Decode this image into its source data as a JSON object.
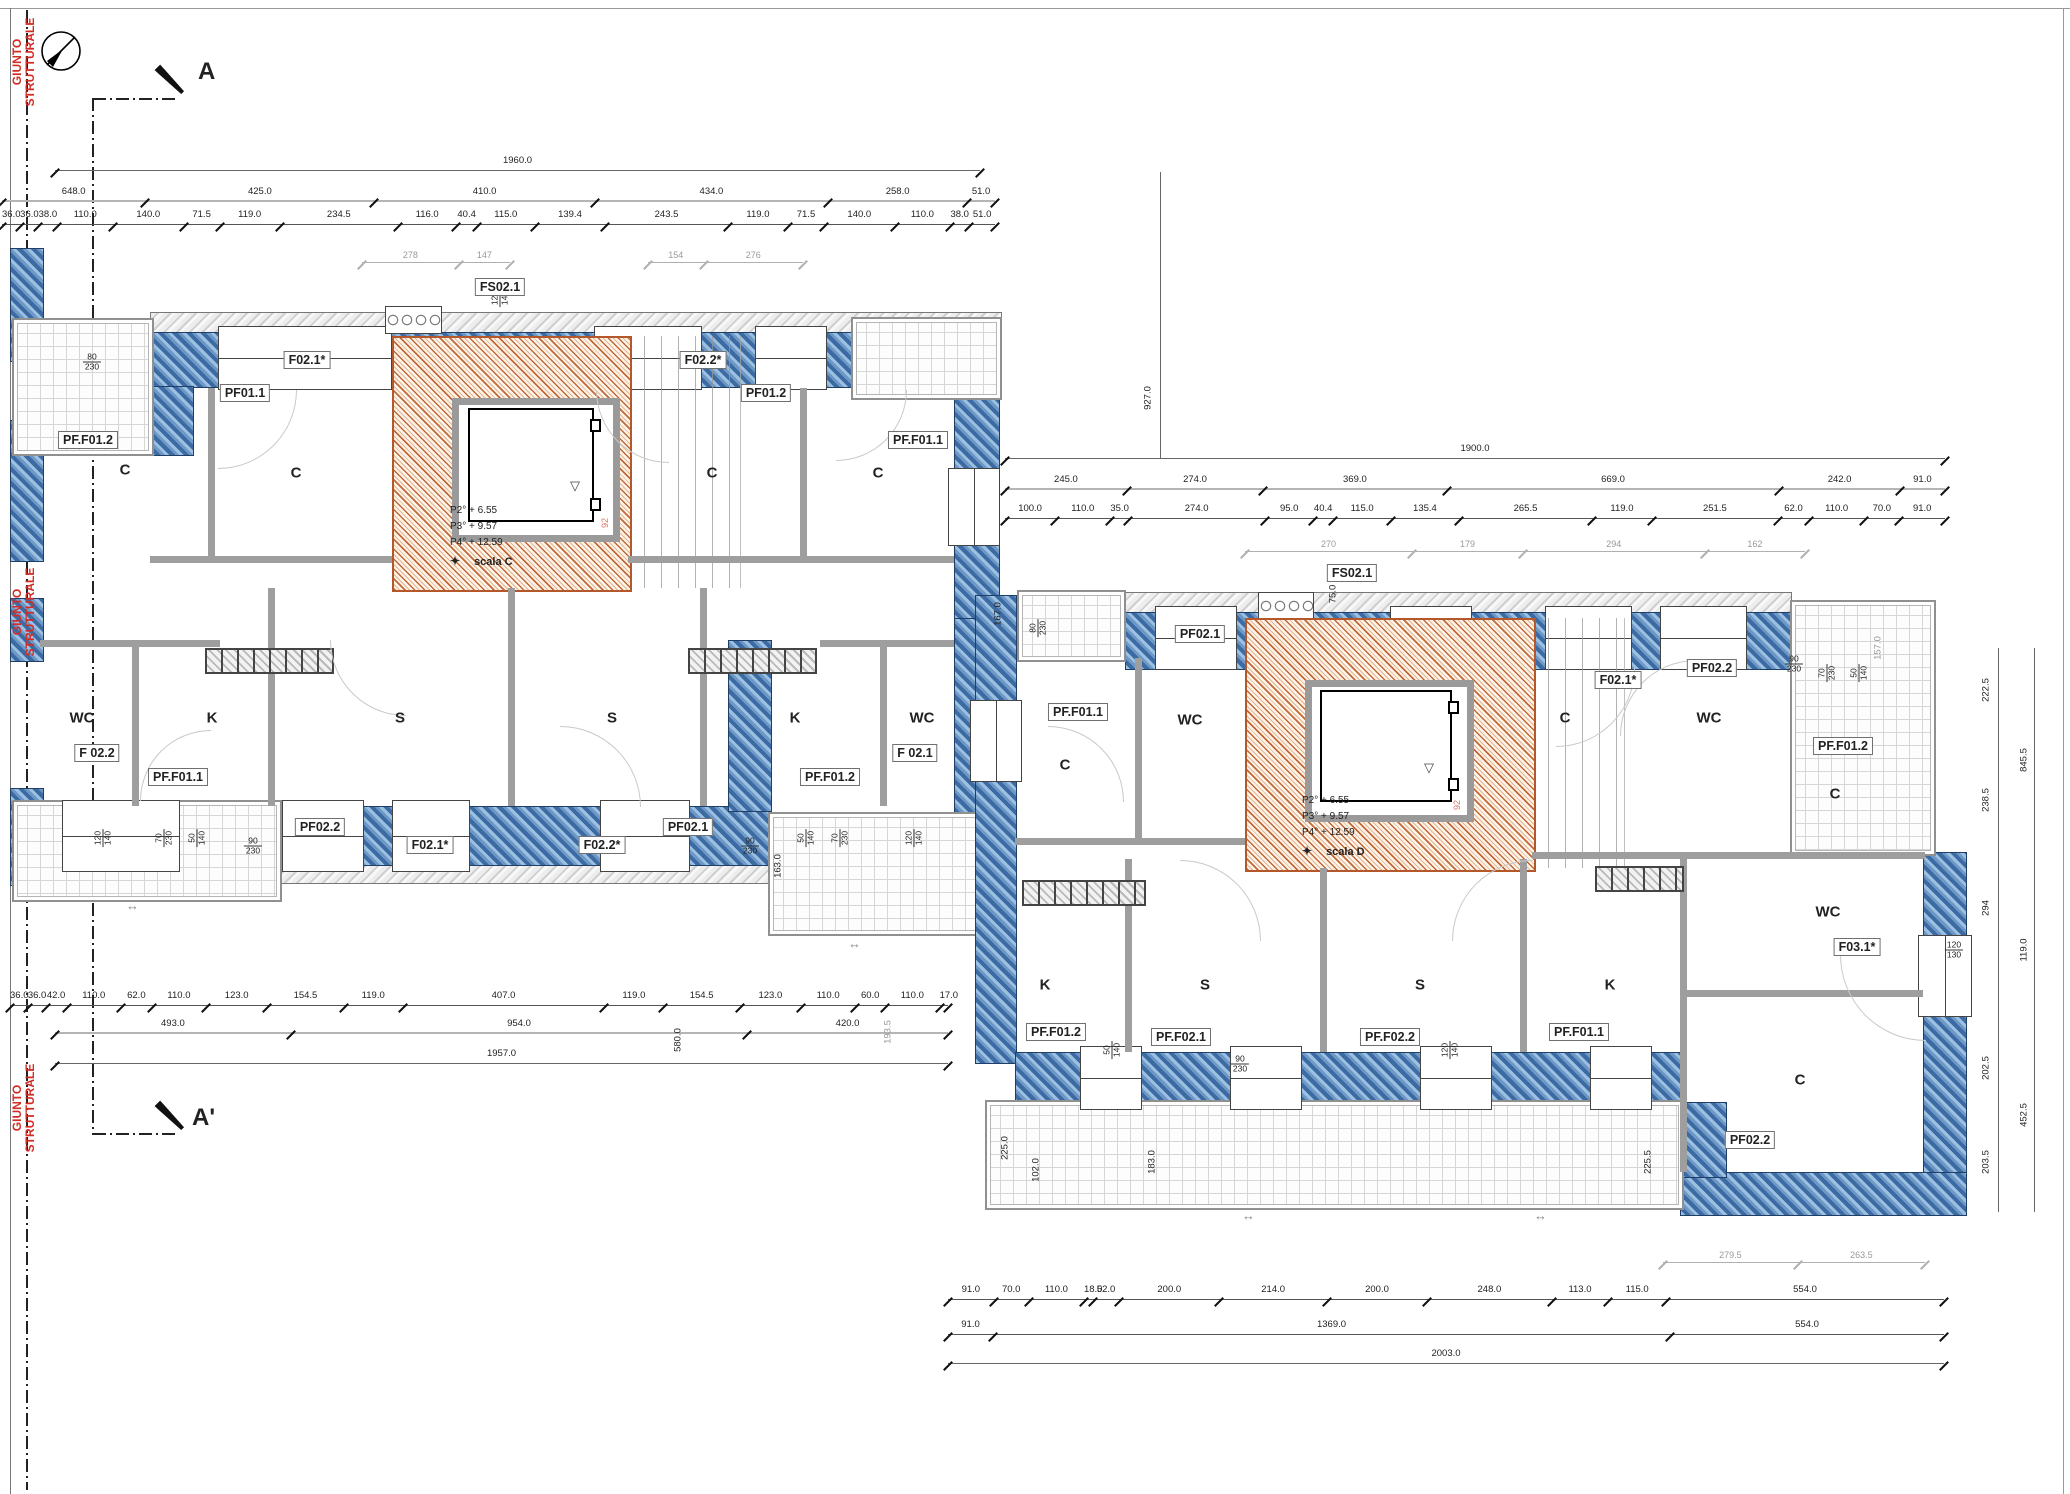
{
  "annotations": {
    "section_a": "A",
    "section_a_prime": "A'",
    "joint_label_line1": "GIUNTO",
    "joint_label_line2": "STRUTTURALE",
    "joint_color": "#d22c24"
  },
  "stairs": {
    "scala_c": {
      "levels": [
        "P2° + 6.55",
        "P3° + 9.57",
        "P4° + 12.59"
      ],
      "name": "scala C",
      "mark": "92"
    },
    "scala_d": {
      "levels": [
        "P2° + 6.55",
        "P3° + 9.57",
        "P4° + 12.59"
      ],
      "name": "scala D",
      "mark": "92"
    }
  },
  "left_wing": {
    "rooms": [
      "C",
      "C",
      "C",
      "C",
      "WC",
      "K",
      "S",
      "S",
      "K",
      "WC"
    ],
    "tags": [
      "FS02.1",
      "F02.1*",
      "PF01.1",
      "F02.2*",
      "PF01.2",
      "PF.F01.1",
      "PF.F01.2",
      "F 02.2",
      "F 02.1",
      "PF.F01.1",
      "PF.F01.2",
      "PF02.2",
      "PF02.1",
      "F02.1*",
      "F02.2*"
    ]
  },
  "right_wing": {
    "rooms": [
      "C",
      "WC",
      "C",
      "WC",
      "C",
      "K",
      "S",
      "S",
      "K",
      "WC",
      "C"
    ],
    "tags": [
      "FS02.1",
      "PF02.1",
      "F02.1*",
      "PF02.2",
      "PF.F01.1",
      "PF.F01.2",
      "F03.1*",
      "PF.F01.2",
      "PF.F02.1",
      "PF.F02.2",
      "PF.F01.1",
      "PF02.2"
    ]
  },
  "dims": {
    "lw_top_total": "1960.0",
    "lw_top_major": [
      "648.0",
      "425.0",
      "410.0",
      "434.0",
      "258.0",
      "51.0"
    ],
    "lw_top_minor": [
      "36.0",
      "36.0",
      "38.0",
      "110.0",
      "140.0",
      "71.5",
      "119.0",
      "234.5",
      "116.0",
      "40.4",
      "115.0",
      "139.4",
      "243.5",
      "119.0",
      "71.5",
      "140.0",
      "110.0",
      "38.0",
      "51.0"
    ],
    "lw_top_gray_a": [
      "278",
      "147"
    ],
    "lw_top_gray_b": [
      "154",
      "276"
    ],
    "lw_bottom_minor": [
      "36.0",
      "36.0",
      "42.0",
      "110.0",
      "62.0",
      "110.0",
      "123.0",
      "154.5",
      "119.0",
      "407.0",
      "119.0",
      "154.5",
      "123.0",
      "110.0",
      "60.0",
      "110.0",
      "17.0"
    ],
    "lw_bottom_major": [
      "493.0",
      "954.0",
      "420.0"
    ],
    "lw_bottom_total": "1957.0",
    "rw_top_total": "1900.0",
    "rw_top_major": [
      "245.0",
      "274.0",
      "369.0",
      "669.0",
      "242.0",
      "91.0"
    ],
    "rw_top_minor": [
      "100.0",
      "110.0",
      "35.0",
      "274.0",
      "95.0",
      "40.4",
      "115.0",
      "135.4",
      "265.5",
      "119.0",
      "251.5",
      "62.0",
      "110.0",
      "70.0",
      "91.0"
    ],
    "rw_top_gray": [
      "270",
      "179",
      "294",
      "162"
    ],
    "rw_bottom_minor": [
      "91.0",
      "70.0",
      "110.0",
      "18.0",
      "52.0",
      "200.0",
      "214.0",
      "200.0",
      "248.0",
      "113.0",
      "115.0",
      "554.0"
    ],
    "rw_bottom_major": [
      "91.0",
      "1369.0",
      "554.0"
    ],
    "rw_bottom_total": "2003.0",
    "rw_balcony_gray": [
      "279.5",
      "263.5"
    ],
    "verticals": {
      "between_wings": "927.0",
      "lw_depth": "580.0",
      "lw_gray": "193.5",
      "lw_small": "163.0",
      "rw_left": "167.0",
      "rw_balcony_right": "157.0",
      "rw_stair_top": "75.0",
      "right_inner": [
        "222.5",
        "238.5",
        "294",
        "202.5",
        "203.5"
      ],
      "right_outer": [
        "845.5",
        "119.0",
        "452.5"
      ],
      "bottom_balcony": [
        "225.0",
        "102.0",
        "183.0",
        "225.5"
      ]
    },
    "window_pairs": [
      [
        "80",
        "230"
      ],
      [
        "120",
        "140"
      ],
      [
        "70",
        "230"
      ],
      [
        "50",
        "140"
      ],
      [
        "90",
        "230"
      ],
      [
        "120",
        "130"
      ]
    ]
  }
}
